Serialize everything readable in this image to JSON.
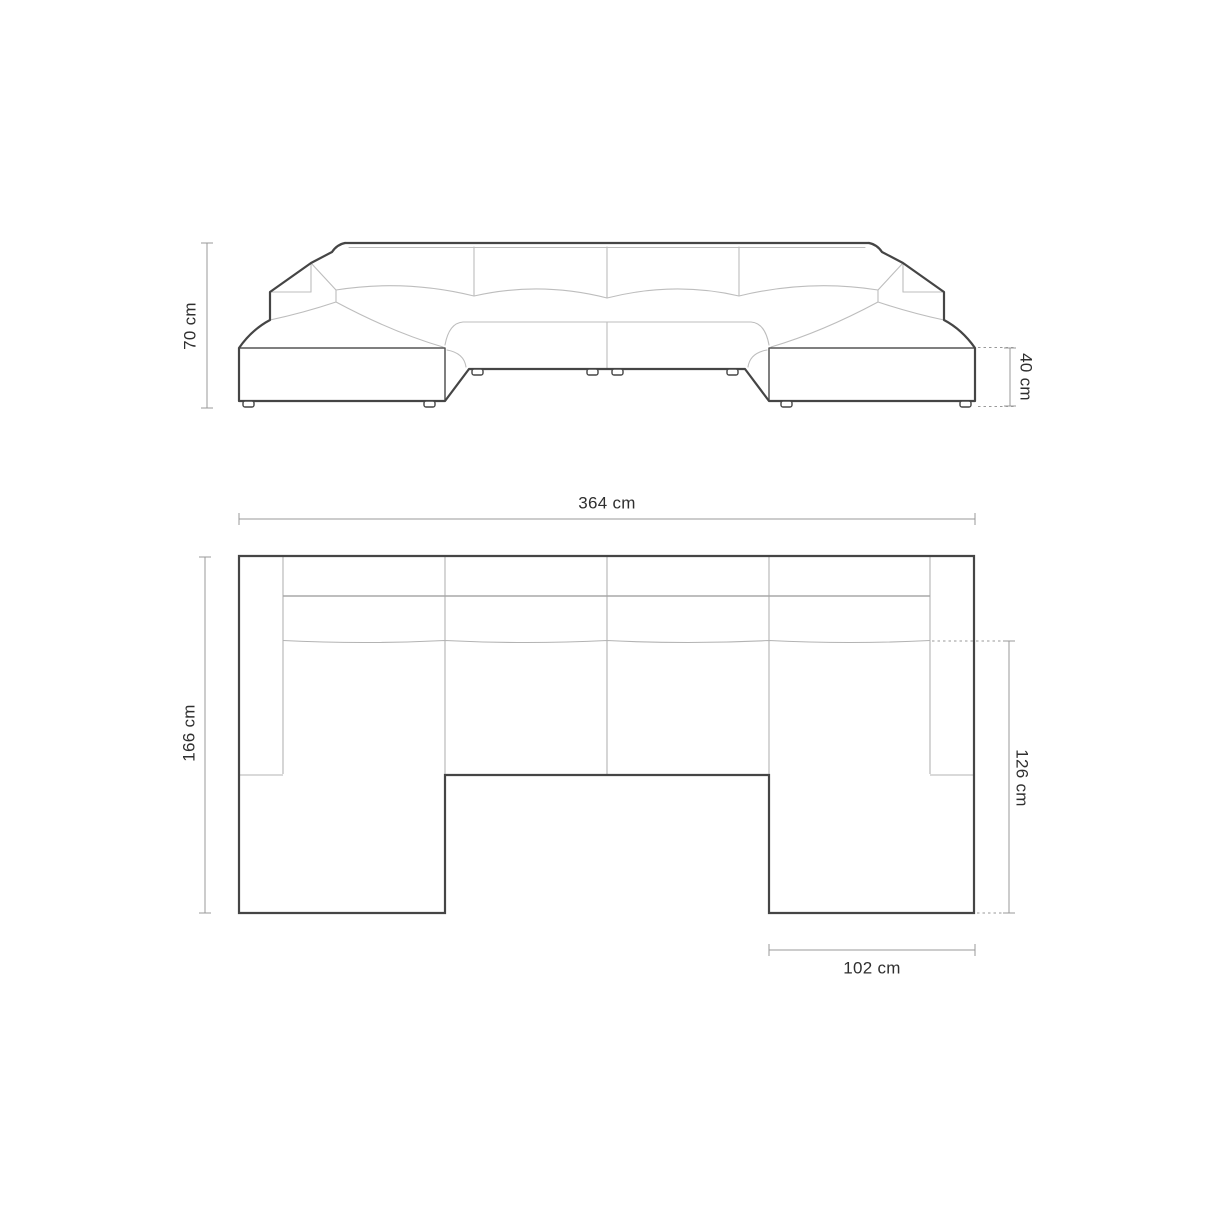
{
  "front_view": {
    "height_label": "70 cm",
    "seat_height_label": "40 cm"
  },
  "top_view": {
    "width_label": "364 cm",
    "depth_label": "166 cm",
    "chaise_depth_label": "126 cm",
    "chaise_width_label": "102 cm"
  },
  "colors": {
    "background": "#ffffff",
    "outline": "#454545",
    "detail_line": "#bdbdbd",
    "dimension_line": "#999999",
    "label_text": "#2f2f2f"
  }
}
